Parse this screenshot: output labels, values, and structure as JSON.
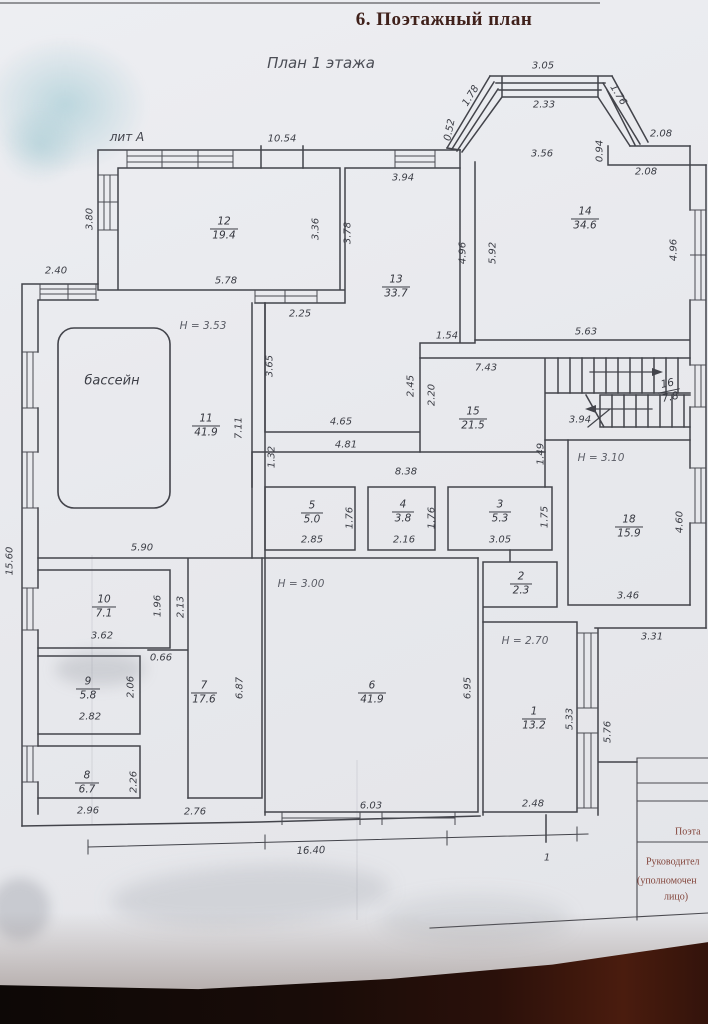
{
  "title": "6. Поэтажный план",
  "subtitle": "План 1 этажа",
  "building_label": "лит А",
  "pool_label": "бассейн",
  "heights": {
    "h11": "H = 3.53",
    "h6": "H = 3.00",
    "h18": "H = 3.10",
    "h1": "H = 2.70"
  },
  "rooms": {
    "r1": {
      "num": "1",
      "area": "13.2"
    },
    "r2": {
      "num": "2",
      "area": "2.3"
    },
    "r3": {
      "num": "3",
      "area": "5.3"
    },
    "r4": {
      "num": "4",
      "area": "3.8"
    },
    "r5": {
      "num": "5",
      "area": "5.0"
    },
    "r6": {
      "num": "6",
      "area": "41.9"
    },
    "r7": {
      "num": "7",
      "area": "17.6"
    },
    "r8": {
      "num": "8",
      "area": "6.7"
    },
    "r9": {
      "num": "9",
      "area": "5.8"
    },
    "r10": {
      "num": "10",
      "area": "7.1"
    },
    "r11": {
      "num": "11",
      "area": "41.9"
    },
    "r12": {
      "num": "12",
      "area": "19.4"
    },
    "r13": {
      "num": "13",
      "area": "33.7"
    },
    "r14": {
      "num": "14",
      "area": "34.6"
    },
    "r15": {
      "num": "15",
      "area": "21.5"
    },
    "r16": {
      "num": "16",
      "area": "7.8"
    },
    "r18": {
      "num": "18",
      "area": "15.9"
    }
  },
  "dims": {
    "top_1054": "10.54",
    "r12_578": "5.78",
    "r12_336": "3.36",
    "r12_380": "3.80",
    "r12_378": "3.78",
    "r13_394": "3.94",
    "r13_496": "4.96",
    "r13_225": "2.25",
    "r13_154": "1.54",
    "r13_365": "3.65",
    "bay_305": "3.05",
    "bay_233": "2.33",
    "bay_178": "1.78",
    "bay_176": "1.76",
    "bay_052": "0.52",
    "bay_094": "0.94",
    "bay_208a": "2.08",
    "bay_208b": "2.08",
    "r14_356": "3.56",
    "r14_592": "5.92",
    "r14_496": "4.96",
    "r14_563": "5.63",
    "left_240": "2.40",
    "left_1560": "15.60",
    "r11_711": "7.11",
    "r11_132": "1.32",
    "r15_743": "7.43",
    "r15_245": "2.45",
    "r15_220": "2.20",
    "stair_394": "3.94",
    "d149": "1.49",
    "corr_465": "4.65",
    "corr_481": "4.81",
    "corr_838": "8.38",
    "r5_285": "2.85",
    "r5_176": "1.76",
    "r4_216": "2.16",
    "r4_176": "1.76",
    "r3_305": "3.05",
    "r3_175": "1.75",
    "r18_346": "3.46",
    "r18_460": "4.60",
    "d331": "3.31",
    "r10_590": "5.90",
    "r10_362": "3.62",
    "r10_196": "1.96",
    "d213": "2.13",
    "d066": "0.66",
    "r9_282": "2.82",
    "r9_206": "2.06",
    "r8_296": "2.96",
    "r8_226": "2.26",
    "r7_687": "6.87",
    "r7_276": "2.76",
    "r6_695": "6.95",
    "r6_603": "6.03",
    "r1_248": "2.48",
    "r1_533": "5.33",
    "d576": "5.76",
    "total_1640": "16.40",
    "mark_1": "1"
  },
  "footer": {
    "col1": "Поэта",
    "line1": "Руководител",
    "line2": "(уполномочен",
    "line3": "лицо)"
  }
}
